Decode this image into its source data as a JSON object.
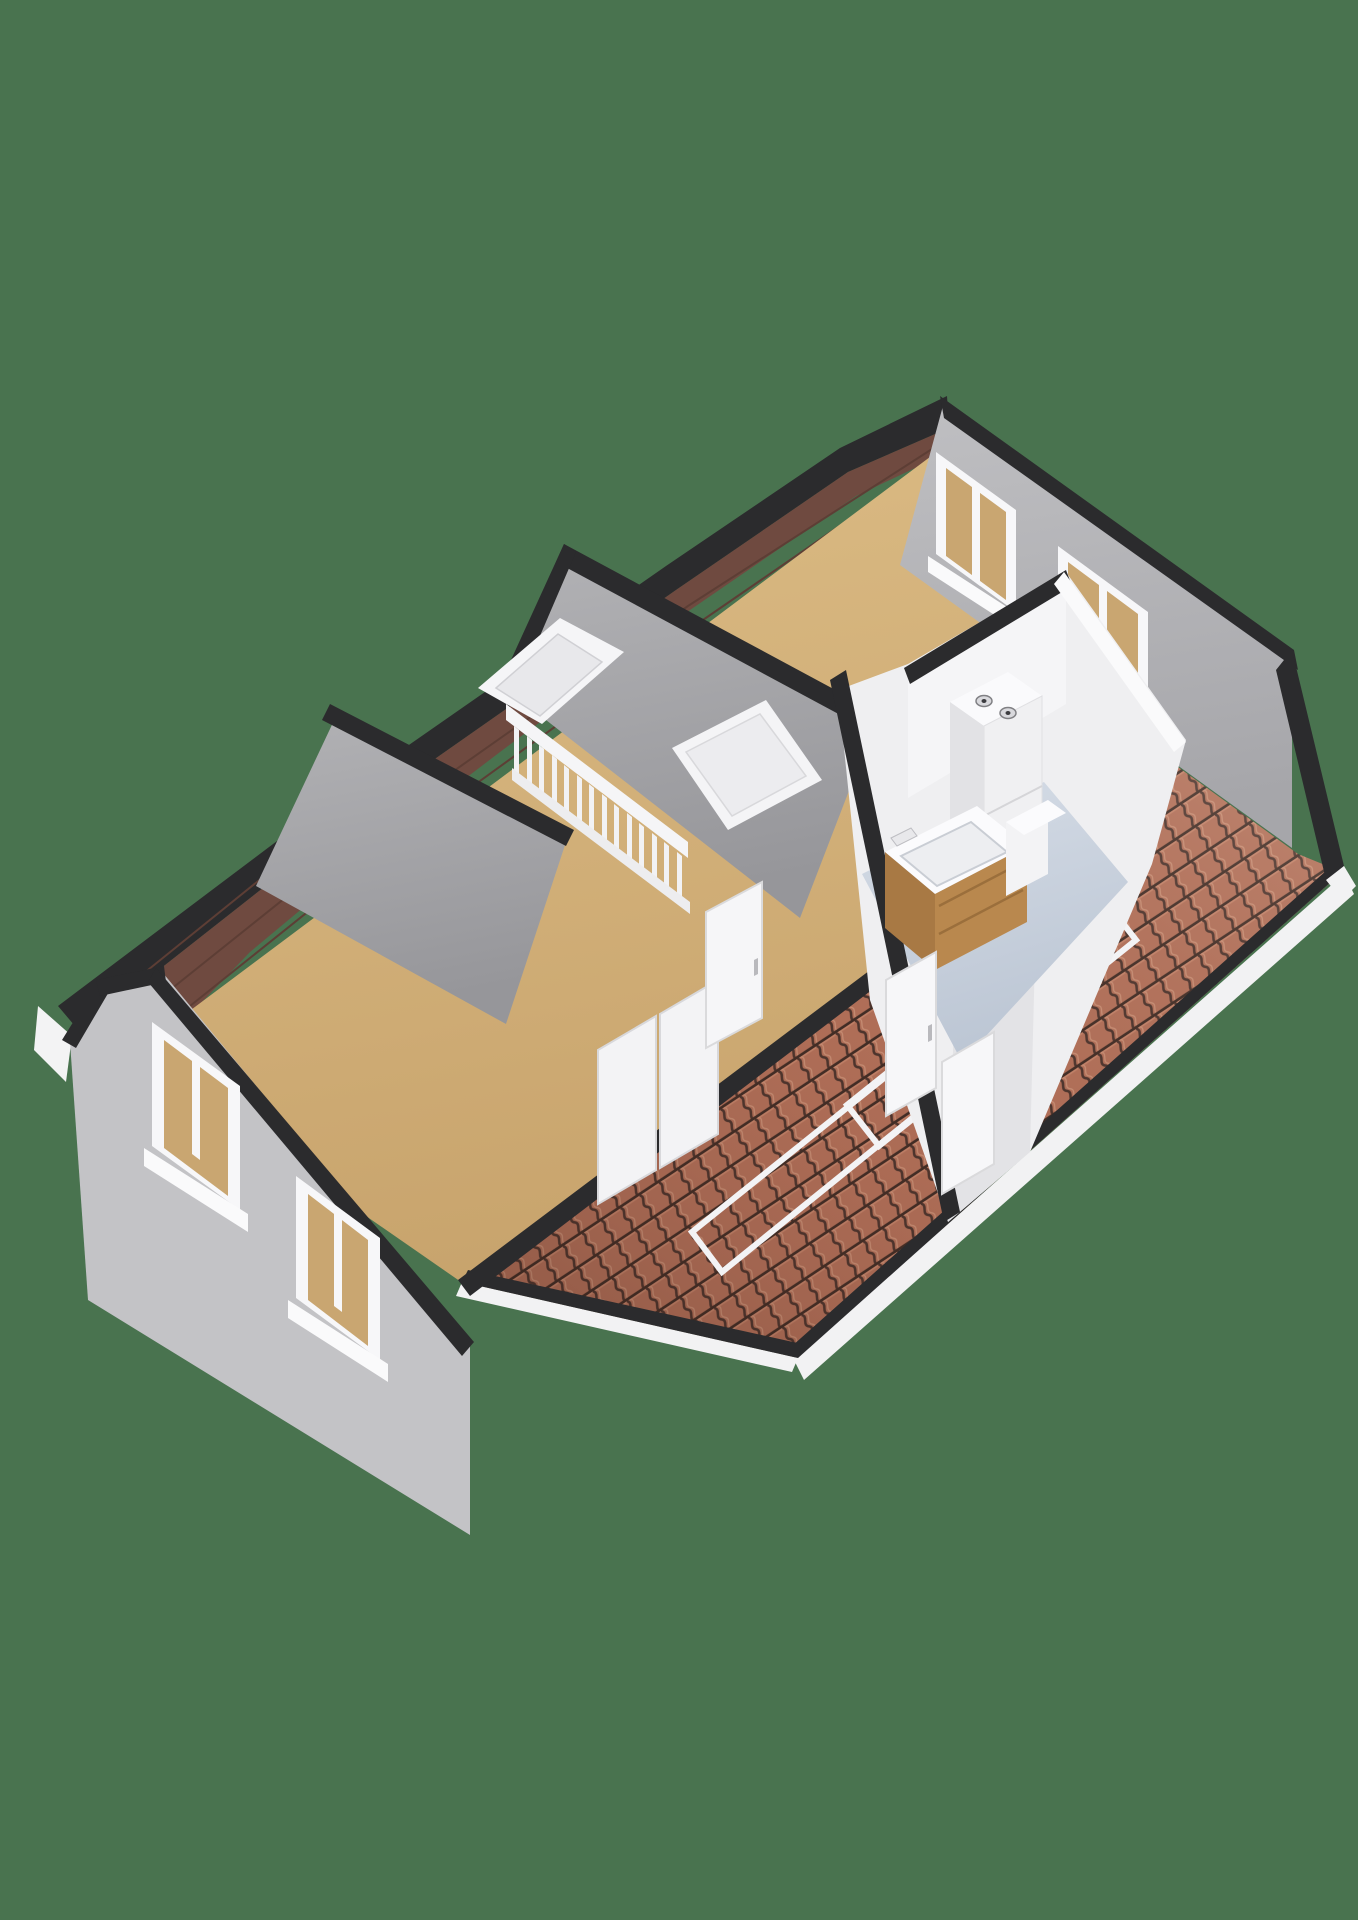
{
  "scene": {
    "description": "3d-floorplan-attic-storey",
    "canvas": {
      "width": 1358,
      "height": 1920
    },
    "background_color": "#49734F",
    "palette": {
      "background_green": "#49734F",
      "floor_tan": "#D2B077",
      "wood_roof_underside": "#6F4A40",
      "cut_wall_black": "#2B2B2D",
      "slope_gray": "#A9A9AC",
      "gable_wall_gray": "#BFBFC2",
      "tile_terracotta": "#B27059",
      "tile_groove": "#4A332C",
      "window_blind_tan": "#C9A671",
      "frame_white": "#F5F5F7",
      "bathroom_floor_blue": "#C9D2DF",
      "vanity_wood": "#B9884E"
    },
    "gradients": [
      {
        "id": "gFloor",
        "x1": "0",
        "y1": "0",
        "x2": "0.25",
        "y2": "1",
        "stops": [
          {
            "offset": "0",
            "color": "#DCBC85",
            "opacity": "1"
          },
          {
            "offset": "1",
            "color": "#C8A46D",
            "opacity": "1"
          }
        ]
      },
      {
        "id": "gSlope",
        "x1": "0",
        "y1": "0",
        "x2": "0.2",
        "y2": "1",
        "stops": [
          {
            "offset": "0",
            "color": "#B2B2B5",
            "opacity": "1"
          },
          {
            "offset": "1",
            "color": "#96969A",
            "opacity": "1"
          }
        ]
      },
      {
        "id": "gWall",
        "x1": "0",
        "y1": "0",
        "x2": "0.15",
        "y2": "1",
        "stops": [
          {
            "offset": "0",
            "color": "#BFBFC2",
            "opacity": "1"
          },
          {
            "offset": "1",
            "color": "#A6A6AA",
            "opacity": "1"
          }
        ]
      },
      {
        "id": "gBlue",
        "x1": "0",
        "y1": "0",
        "x2": "0.3",
        "y2": "1",
        "stops": [
          {
            "offset": "0",
            "color": "#D6DDE7",
            "opacity": "1"
          },
          {
            "offset": "1",
            "color": "#BCC6D4",
            "opacity": "1"
          }
        ]
      },
      {
        "id": "gTileShade",
        "x1": "1",
        "y1": "0",
        "x2": "0",
        "y2": "1",
        "stops": [
          {
            "offset": "0",
            "color": "#FFF0E4",
            "opacity": "0.18"
          },
          {
            "offset": "0.5",
            "color": "#7A4534",
            "opacity": "0.05"
          },
          {
            "offset": "1",
            "color": "#2E1710",
            "opacity": "0.28"
          }
        ]
      }
    ],
    "tile_pattern": {
      "id": "tilePat",
      "width": 23,
      "height": 27,
      "rotation": -33.5,
      "base": "#B27059",
      "wave_path": "M11.5,0 C17,4.5 6,9 11.5,13.5 C17,18 6,22.5 11.5,27",
      "wave_stroke": "#4A332C",
      "wave_width": 2.6,
      "wave2_stroke": "#C98F75",
      "wave2_width": 1.3,
      "wave2_dx": 4,
      "course_stroke": "#3E2B24",
      "course_width": 3.2,
      "highlight_stroke": "#C4846A",
      "highlight_width": 1.4
    },
    "shapes": [
      {
        "n": "background",
        "p": "0,0 1358,0 1358,1920 0,1920",
        "f": "#49734F"
      },
      {
        "n": "fascia-left-corner",
        "p": "38,1006 72,1036 66,1082 34,1050",
        "f": "#F3F3F4"
      },
      {
        "n": "ridge-edge-black",
        "p": "58,1006 350,786 666,566 840,448 947,396 949,428 848,472 676,590 362,810 80,1032",
        "f": "#2B2B2D"
      },
      {
        "n": "roof-underside-wood",
        "p": "80,1032 362,810 676,590 848,472 949,428 949,452 856,496 690,610 500,752 382,842 250,952 150,1056 96,1092",
        "f": "#6F4A40"
      },
      {
        "n": "wood-plank-line",
        "pl": "100,1046 370,830 688,606 946,440",
        "s": "#5D3E35",
        "sw": 2
      },
      {
        "n": "wood-plank-line",
        "pl": "120,1062 390,846 700,622 947,452",
        "s": "#5D3E35",
        "sw": 2
      },
      {
        "n": "wood-plank-line",
        "pl": "86,1020 356,802",
        "s": "#5D3E35",
        "sw": 2
      },
      {
        "n": "attic-floor",
        "p": "108,1072 950,442 1296,662 1160,756 464,1284 242,1130",
        "f": "url(#gFloor)"
      },
      {
        "n": "roof-tiles",
        "p": "1160,754 1298,854 1342,872 798,1358 462,1282",
        "f": "url(#tilePat)"
      },
      {
        "n": "roof-tiles-shading",
        "p": "1160,754 1298,854 1342,872 798,1358 462,1282",
        "f": "url(#gTileShade)"
      },
      {
        "n": "eaves-fascia-white",
        "p": "1344,874 1354,894 804,1380 794,1360",
        "f": "#F2F2F3"
      },
      {
        "n": "eaves-fascia-white-left",
        "p": "462,1282 798,1358 792,1372 456,1296",
        "f": "#F2F2F3"
      },
      {
        "n": "eaves-trim-black",
        "p": "1342,872 798,1358 792,1346 1336,862",
        "f": "#2B2B2D"
      },
      {
        "n": "eaves-trim-black-left",
        "p": "798,1358 462,1282 468,1270 802,1344",
        "f": "#2B2B2D"
      },
      {
        "n": "roof-window-frame",
        "p": "847,1105 1104,899 1136,940 879,1146",
        "f": "none",
        "s": "#F3F3F5",
        "sw": 6
      },
      {
        "n": "roof-window-frame",
        "p": "692,1232 949,1026 979,1064 722,1272",
        "f": "none",
        "s": "#F3F3F5",
        "sw": 6
      },
      {
        "n": "roof-vent-dash",
        "p": "1062,858 1090,862 1090,871 1062,867",
        "f": "#F3F3F5"
      },
      {
        "n": "tiles-inner-edge-black",
        "p": "1160,752 1166,766 470,1296 458,1280",
        "f": "#2B2B2D"
      },
      {
        "n": "gable-wall-right",
        "p": "944,402 1292,652 1292,848 900,565",
        "f": "url(#gWall)"
      },
      {
        "n": "gable-wall-right-cap",
        "p": "940,396 1294,650 1298,670 944,418",
        "f": "#2B2B2D"
      },
      {
        "n": "gable-rake-black",
        "p": "1292,650 1344,866 1326,880 1276,670",
        "f": "#2B2B2D"
      },
      {
        "n": "gable-rake-fascia",
        "p": "1344,866 1356,886 1342,900 1326,880",
        "f": "#F2F2F3"
      },
      {
        "n": "window-frame",
        "p": "936,452 1016,510 1016,612 936,554",
        "f": "#F7F7F9"
      },
      {
        "n": "window-blind",
        "p": "946,468 1006,512 1006,600 946,556",
        "f": "#C9A671"
      },
      {
        "n": "window-mullion",
        "p": "972,486 980,492 980,586 972,580",
        "f": "#F7F7F9"
      },
      {
        "n": "window-sill",
        "p": "928,556 1024,618 1024,634 928,572",
        "f": "#FAFAFB"
      },
      {
        "n": "window-frame",
        "p": "1058,546 1148,612 1148,716 1058,650",
        "f": "#F7F7F9"
      },
      {
        "n": "window-blind",
        "p": "1068,562 1138,614 1138,704 1068,652",
        "f": "#C9A671"
      },
      {
        "n": "window-mullion",
        "p": "1099,584 1107,590 1107,686 1099,680",
        "f": "#F7F7F9"
      },
      {
        "n": "window-sill",
        "p": "1050,652 1156,720 1156,736 1050,668",
        "f": "#FAFAFB"
      },
      {
        "n": "ceiling-slope-center",
        "p": "570,552 877,718 800,918 505,688",
        "f": "url(#gSlope)"
      },
      {
        "n": "ceiling-slope-ridge-black",
        "p": "564,544 880,714 872,732 556,562",
        "f": "#2B2B2D"
      },
      {
        "n": "ceiling-slope-edge-black",
        "p": "564,544 576,552 515,694 500,684",
        "f": "#2B2B2D"
      },
      {
        "n": "ceiling-slope-left",
        "p": "338,712 568,836 506,1024 256,886",
        "f": "url(#gSlope)"
      },
      {
        "n": "ceiling-slope-ridge-black",
        "p": "330,704 574,830 566,846 322,720",
        "f": "#2B2B2D"
      },
      {
        "n": "skylight-frame",
        "p": "478,688 560,618 624,652 542,724",
        "f": "#F5F5F7"
      },
      {
        "n": "skylight-glass",
        "p": "496,688 558,634 602,662 540,716",
        "f": "#E8E8EB",
        "s": "#D0D0D4",
        "sw": 1.5
      },
      {
        "n": "ceiling-window-frame",
        "p": "672,748 766,700 822,780 728,830",
        "f": "#F4F4F6"
      },
      {
        "n": "ceiling-window-glass",
        "p": "686,752 760,714 806,776 732,816",
        "f": "#ECECEF",
        "s": "#D8D8DB",
        "sw": 1.5
      },
      {
        "n": "stair-handrail",
        "p": "506,704 688,842 688,858 506,720",
        "f": "#F5F5F7"
      },
      {
        "n": "stair-baluster",
        "p": "514,726 519,730 519,776 514,772",
        "f": "#F2F2F4"
      },
      {
        "n": "stair-baluster",
        "p": "527,736 532,740 532,786 527,782",
        "f": "#F2F2F4"
      },
      {
        "n": "stair-baluster",
        "p": "539,745 544,749 544,795 539,791",
        "f": "#F2F2F4"
      },
      {
        "n": "stair-baluster",
        "p": "552,755 557,759 557,805 552,801",
        "f": "#F2F2F4"
      },
      {
        "n": "stair-baluster",
        "p": "564,765 569,769 569,815 564,811",
        "f": "#F2F2F4"
      },
      {
        "n": "stair-baluster",
        "p": "577,775 582,779 582,825 577,821",
        "f": "#F2F2F4"
      },
      {
        "n": "stair-baluster",
        "p": "589,784 594,788 594,834 589,830",
        "f": "#F2F2F4"
      },
      {
        "n": "stair-baluster",
        "p": "602,794 607,798 607,844 602,840",
        "f": "#F2F2F4"
      },
      {
        "n": "stair-baluster",
        "p": "614,804 619,808 619,854 614,850",
        "f": "#F2F2F4"
      },
      {
        "n": "stair-baluster",
        "p": "627,813 632,817 632,863 627,859",
        "f": "#F2F2F4"
      },
      {
        "n": "stair-baluster",
        "p": "639,823 644,827 644,873 639,869",
        "f": "#F2F2F4"
      },
      {
        "n": "stair-baluster",
        "p": "652,833 657,837 657,883 652,879",
        "f": "#F2F2F4"
      },
      {
        "n": "stair-baluster",
        "p": "664,842 669,846 669,892 664,888",
        "f": "#F2F2F4"
      },
      {
        "n": "stair-baluster",
        "p": "677,852 682,856 682,902 677,898",
        "f": "#F2F2F4"
      },
      {
        "n": "stair-bottomrail",
        "p": "512,768 690,902 690,914 512,780",
        "f": "#EDEDEF"
      },
      {
        "n": "wardrobe-door",
        "p": "598,1050 656,1016 656,1170 598,1204",
        "f": "#F3F3F5",
        "s": "#D8D8DB",
        "sw": 2
      },
      {
        "n": "wardrobe-door",
        "p": "660,1014 718,980 718,1134 660,1168",
        "f": "#F3F3F5",
        "s": "#D8D8DB",
        "sw": 2
      },
      {
        "n": "room-door",
        "p": "706,912 762,882 762,1018 706,1048",
        "f": "#F6F6F8",
        "s": "#DADADC",
        "sw": 2
      },
      {
        "n": "door-handle",
        "p": "754,960 758,958 758,974 754,976",
        "f": "#B9B9BD"
      },
      {
        "n": "bathroom-walls",
        "p": "908,664 1066,572 1186,740 1152,864 1030,1152 948,1222 870,1000 838,690",
        "f": "#EFEFF1"
      },
      {
        "n": "bathroom-wall-shade",
        "p": "958,880 1038,838 1030,1152 948,1222",
        "f": "#E3E3E6"
      },
      {
        "n": "bathroom-floor",
        "p": "862,874 1044,782 1128,882 962,1062",
        "f": "url(#gBlue)"
      },
      {
        "n": "bathroom-backwall",
        "p": "908,668 1066,572 1066,704 908,798",
        "f": "#F5F5F7"
      },
      {
        "n": "bathroom-wall-cap-black",
        "p": "830,680 846,670 960,1212 944,1222",
        "f": "#2B2B2D"
      },
      {
        "n": "bathroom-wall-cap-black",
        "p": "904,668 1066,570 1072,586 910,684",
        "f": "#2B2B2D"
      },
      {
        "n": "bathroom-wall-cap-white",
        "p": "1064,572 1186,742 1174,752 1054,584",
        "f": "#FAFAFB"
      },
      {
        "n": "boiler-top",
        "p": "950,702 1008,672 1042,696 984,726",
        "f": "#FAFAFC"
      },
      {
        "n": "boiler-front",
        "p": "984,726 1042,696 1042,822 984,852",
        "f": "#F0F0F2",
        "s": "#E0E0E3",
        "sw": 1
      },
      {
        "n": "boiler-side",
        "p": "950,702 984,726 984,852 950,828",
        "f": "#E2E2E5"
      },
      {
        "n": "boiler-vent",
        "e": [
          984,
          701,
          8,
          5.5
        ],
        "f": "#D9D9DD",
        "s": "#808084",
        "sw": 1.5
      },
      {
        "n": "boiler-vent-dot",
        "e": [
          984,
          701,
          2.5,
          2
        ],
        "f": "#3C3C40"
      },
      {
        "n": "boiler-vent",
        "e": [
          1008,
          713,
          8,
          5.5
        ],
        "f": "#D9D9DD",
        "s": "#808084",
        "sw": 1.5
      },
      {
        "n": "boiler-vent-dot",
        "e": [
          1008,
          713,
          2.5,
          2
        ],
        "f": "#3C3C40"
      },
      {
        "n": "boiler-panel-line",
        "pl": "984,816 1042,786",
        "s": "#D5D5D8",
        "sw": 2
      },
      {
        "n": "vanity-top",
        "p": "885,852 977,806 1027,846 935,894",
        "f": "#FBFBFD"
      },
      {
        "n": "vanity-basin",
        "p": "901,856 971,822 1007,852 937,886",
        "f": "#EDEEF1",
        "s": "#C9CDD4",
        "sw": 2
      },
      {
        "n": "vanity-faucet",
        "p": "891,838 911,828 917,836 897,846",
        "f": "#E8E8EB",
        "s": "#BDBDC2",
        "sw": 1
      },
      {
        "n": "vanity-front",
        "p": "935,894 1027,846 1027,922 935,970",
        "f": "#B9884E"
      },
      {
        "n": "vanity-drawer-line",
        "pl": "939,906 1023,862",
        "s": "#9B6F3C",
        "sw": 2.5
      },
      {
        "n": "vanity-drawer-line",
        "pl": "939,934 1023,890",
        "s": "#9B6F3C",
        "sw": 2.5
      },
      {
        "n": "vanity-side",
        "p": "885,852 935,894 935,970 885,928",
        "f": "#A87944"
      },
      {
        "n": "toilet-cistern-front",
        "p": "1006,822 1048,800 1048,874 1006,896",
        "f": "#F3F3F5"
      },
      {
        "n": "toilet-cistern-top",
        "p": "1006,822 1048,800 1066,813 1024,835",
        "f": "#FBFBFD"
      },
      {
        "n": "bathroom-door",
        "p": "886,980 936,952 936,1088 886,1116",
        "f": "#F7F7F9",
        "s": "#DADADC",
        "sw": 2
      },
      {
        "n": "door-handle",
        "p": "928,1026 932,1024 932,1040 928,1042",
        "f": "#B9B9BD"
      },
      {
        "n": "bathroom-door",
        "p": "942,1062 994,1032 994,1164 942,1194",
        "f": "#F7F7F9",
        "s": "#DADADC",
        "sw": 2
      },
      {
        "n": "gable-wall-left",
        "p": "70,1042 100,987 163,973 470,1345 470,1535 88,1300",
        "f": "#C3C3C6"
      },
      {
        "n": "gable-wall-left-cap",
        "p": "62,1040 98,982 110,990 76,1048",
        "f": "#2B2B2D"
      },
      {
        "n": "gable-wall-left-cap",
        "p": "96,980 164,966 166,982 100,996",
        "f": "#2B2B2D"
      },
      {
        "n": "gable-wall-left-cap",
        "p": "156,968 474,1342 462,1356 148,982",
        "f": "#2B2B2D"
      },
      {
        "n": "window-frame",
        "p": "152,1022 240,1086 240,1210 152,1146",
        "f": "#F7F7F9"
      },
      {
        "n": "window-blind",
        "p": "164,1040 228,1088 228,1196 164,1148",
        "f": "#C9A671"
      },
      {
        "n": "window-mullion",
        "p": "192,1056 200,1062 200,1160 192,1154",
        "f": "#F7F7F9"
      },
      {
        "n": "window-sill",
        "p": "144,1148 248,1214 248,1232 144,1166",
        "f": "#FAFAFB"
      },
      {
        "n": "window-frame",
        "p": "296,1176 380,1238 380,1360 296,1298",
        "f": "#F7F7F9"
      },
      {
        "n": "window-blind",
        "p": "308,1194 368,1240 368,1346 308,1300",
        "f": "#C9A671"
      },
      {
        "n": "window-mullion",
        "p": "334,1208 342,1214 342,1312 334,1306",
        "f": "#F7F7F9"
      },
      {
        "n": "window-sill",
        "p": "288,1300 388,1364 388,1382 288,1318",
        "f": "#FAFAFB"
      }
    ]
  }
}
